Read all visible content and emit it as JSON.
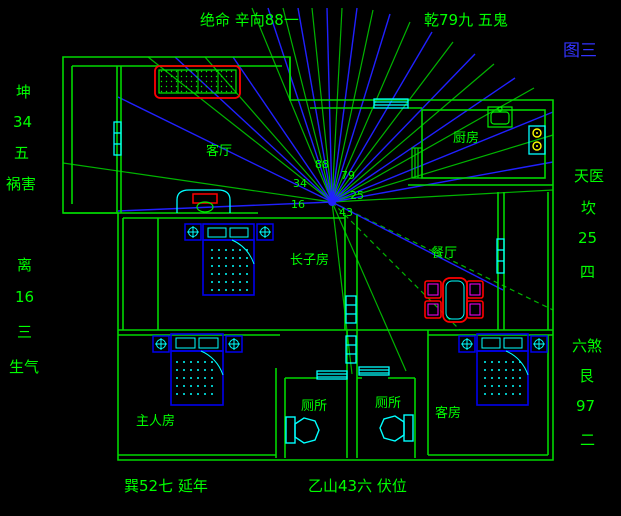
{
  "figure": {
    "title": "图三"
  },
  "compass": {
    "top_left": "绝命 辛向88一",
    "top_right": "乾79九 五鬼",
    "left_upper": [
      "坤",
      "34",
      "五",
      "祸害"
    ],
    "left_lower": [
      "离",
      "16",
      "三",
      "生气"
    ],
    "right_upper": [
      "天医",
      "坎",
      "25",
      "四"
    ],
    "right_lower": [
      "六煞",
      "艮",
      "97",
      "二"
    ],
    "bottom_left": "巽52七 延年",
    "bottom_right": "乙山43六 伏位",
    "center_numbers": {
      "n88": "88",
      "n79": "79",
      "n34": "34",
      "n25": "25",
      "n16": "16",
      "n43": "43"
    }
  },
  "rooms": {
    "living": "客厅",
    "kitchen": "厨房",
    "dining": "餐厅",
    "eldest_son": "长子房",
    "master": "主人房",
    "toilet_left": "厕所",
    "toilet_right": "厕所",
    "guest": "客房"
  },
  "colors": {
    "background": "#000000",
    "wall_green": "#00d800",
    "text_green": "#00ff00",
    "ray_blue": "#2020ff",
    "ray_green": "#00b400",
    "window_cyan": "#00ffff",
    "furniture_red": "#ff0000",
    "furniture_blue": "#0000ee",
    "accent_magenta": "#ff00ff",
    "accent_yellow": "#ffff00",
    "title_blue": "#3333ff"
  }
}
